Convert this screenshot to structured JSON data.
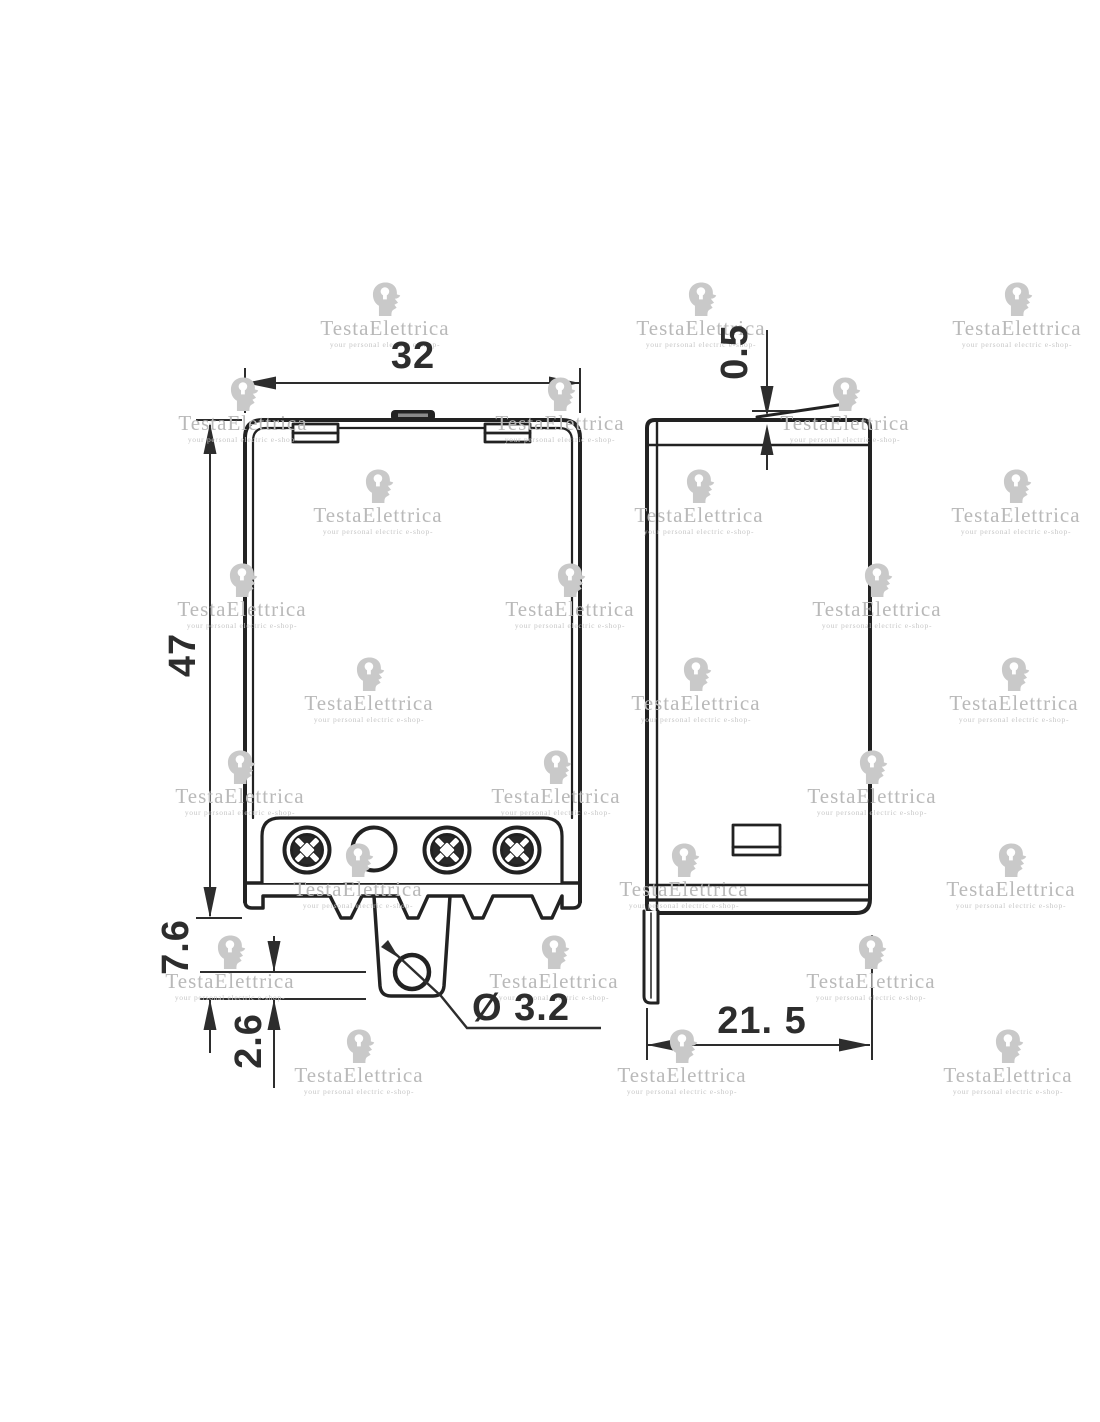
{
  "canvas": {
    "width": 1100,
    "height": 1422,
    "background": "#ffffff"
  },
  "colors": {
    "line": "#222222",
    "dim_text": "#2d2d2d",
    "watermark_text": "#b9b9b9",
    "watermark_subtitle": "#c6c6c6",
    "watermark_icon": "#c9c9c9",
    "connector_fill": "#222222"
  },
  "watermark": {
    "icon": "head-lightbulb-icon",
    "text": "TestaElettrica",
    "subtitle": "your personal electric e-shop-",
    "positions": [
      {
        "x": 385,
        "y": 320
      },
      {
        "x": 701,
        "y": 320
      },
      {
        "x": 1017,
        "y": 320
      },
      {
        "x": 243,
        "y": 415
      },
      {
        "x": 560,
        "y": 415
      },
      {
        "x": 845,
        "y": 415
      },
      {
        "x": 378,
        "y": 507
      },
      {
        "x": 699,
        "y": 507
      },
      {
        "x": 1016,
        "y": 507
      },
      {
        "x": 242,
        "y": 601
      },
      {
        "x": 570,
        "y": 601
      },
      {
        "x": 877,
        "y": 601
      },
      {
        "x": 369,
        "y": 695
      },
      {
        "x": 696,
        "y": 695
      },
      {
        "x": 1014,
        "y": 695
      },
      {
        "x": 240,
        "y": 788
      },
      {
        "x": 556,
        "y": 788
      },
      {
        "x": 872,
        "y": 788
      },
      {
        "x": 358,
        "y": 881
      },
      {
        "x": 684,
        "y": 881
      },
      {
        "x": 1011,
        "y": 881
      },
      {
        "x": 230,
        "y": 973
      },
      {
        "x": 554,
        "y": 973
      },
      {
        "x": 871,
        "y": 973
      },
      {
        "x": 359,
        "y": 1067
      },
      {
        "x": 682,
        "y": 1067
      },
      {
        "x": 1008,
        "y": 1067
      }
    ]
  },
  "drawing": {
    "type": "technical-dimension-drawing",
    "dimension_labels": [
      {
        "id": "width-32",
        "label": "32",
        "x": 413,
        "y": 356,
        "rot": 0
      },
      {
        "id": "height-47",
        "label": "47",
        "x": 183,
        "y": 655,
        "rot": -90
      },
      {
        "id": "depth-7-6",
        "label": "7.6",
        "x": 176,
        "y": 947,
        "rot": -90
      },
      {
        "id": "depth-2-6",
        "label": "2.6",
        "x": 249,
        "y": 1041,
        "rot": -90
      },
      {
        "id": "hole-dia",
        "label": "Ø 3.2",
        "x": 521,
        "y": 1008,
        "rot": 0
      },
      {
        "id": "lid-0-5",
        "label": "0.5",
        "x": 735,
        "y": 352,
        "rot": -90
      },
      {
        "id": "depth-21-5",
        "label": "21. 5",
        "x": 762,
        "y": 1021,
        "rot": 0
      }
    ]
  }
}
